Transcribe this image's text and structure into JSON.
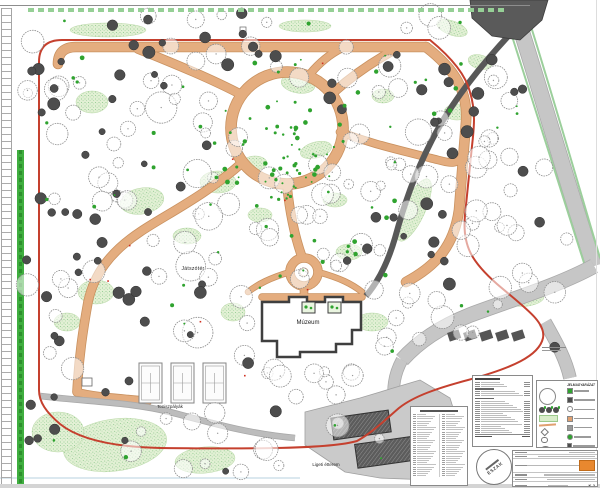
{
  "map_labels": {
    "playground": "Játszótér",
    "museum": "Múzeum",
    "tennis_courts": "Teniszpályák",
    "restaurant": "Ligeti étterem"
  },
  "legend_panel": {
    "title": "JELMAGYARÁZAT"
  },
  "north_arrow": {
    "label": "ÉSZAK"
  },
  "title_block": {
    "drawing_number": "K-2"
  },
  "colors": {
    "path": "#e4ad7f",
    "path_edge": "#c9915f",
    "boundary": "#c5402e",
    "evergreen": "#4d4d4d",
    "tree_outline": "#8f8f8f",
    "shrub_area": "#e2f0d4",
    "shrub_dot": "#8cc88c",
    "accent_green": "#2fa32f",
    "hedge": "#3fae3f",
    "road": "#c6c6c6",
    "dark_path": "#585858",
    "building": "#4f4f4f"
  }
}
